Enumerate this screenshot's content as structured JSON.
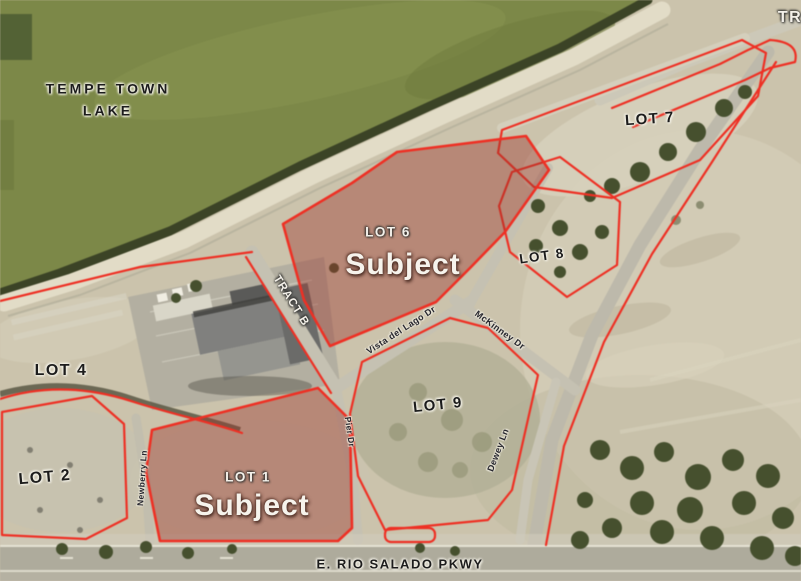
{
  "map": {
    "water": {
      "name_line1": "TEMPE TOWN",
      "name_line2": "LAKE"
    },
    "parcels": {
      "lot1": {
        "label": "LOT 1",
        "tag": "Subject",
        "highlighted": true
      },
      "lot2": {
        "label": "LOT 2",
        "highlighted": false
      },
      "lot4": {
        "label": "LOT 4",
        "highlighted": false
      },
      "lot6": {
        "label": "LOT 6",
        "tag": "Subject",
        "highlighted": true
      },
      "lot7": {
        "label": "LOT 7",
        "highlighted": false
      },
      "lot8": {
        "label": "LOT 8",
        "highlighted": false
      },
      "lot9": {
        "label": "LOT 9",
        "highlighted": false
      },
      "tract_b": {
        "label": "TRACT B"
      },
      "tract_edge": {
        "label": "TR"
      }
    },
    "streets": {
      "rio_salado": "E. RIO SALADO PKWY",
      "vista_del_lago": "Vista del Lago Dr",
      "mckinney": "McKinney Dr",
      "dewey": "Dewey Ln",
      "pier": "Pier Dr",
      "newberry": "Newberry Ln"
    },
    "colors": {
      "lake": "#7c8848",
      "shoreline_dark": "#3b4326",
      "beach_sand": "#e2dcc7",
      "terrain": "#cbc3ac",
      "parcel_outline_red": "#ee3024",
      "subject_parcel_fill": "#a15a4d",
      "road_gray": "#c2beae",
      "label_dark": "#1c1c1c",
      "label_light": "#f3f0e9"
    }
  }
}
